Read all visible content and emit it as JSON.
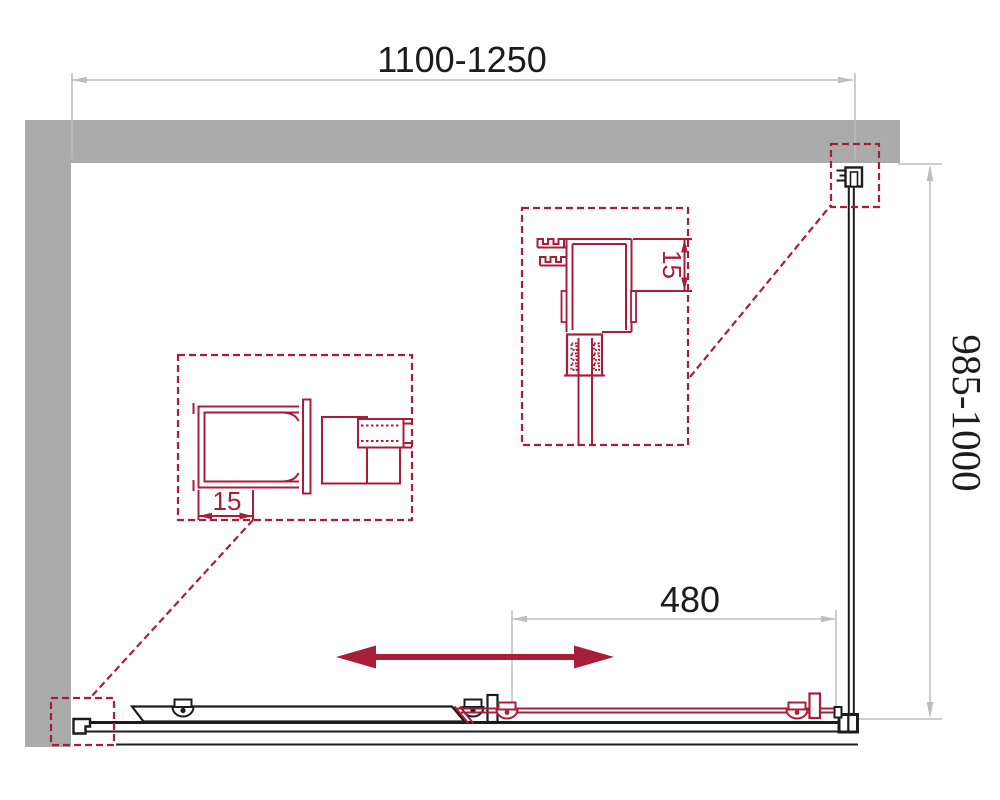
{
  "drawing": {
    "title": "Sliding shower door enclosure — dimensional drawing",
    "dimensions": {
      "overall_width": "1100-1250",
      "overall_depth": "985-1000",
      "door_panel_width": "480",
      "left_profile_adjustment": "15",
      "wall_profile_adjustment": "15"
    },
    "icons": {
      "slide_direction": "double-headed-arrow"
    }
  },
  "colors": {
    "wall_gray": "#ABABAB",
    "profile_red": "#A81E38",
    "line_black": "#1C1C1C",
    "dim_gray": "#BDBDBD"
  }
}
